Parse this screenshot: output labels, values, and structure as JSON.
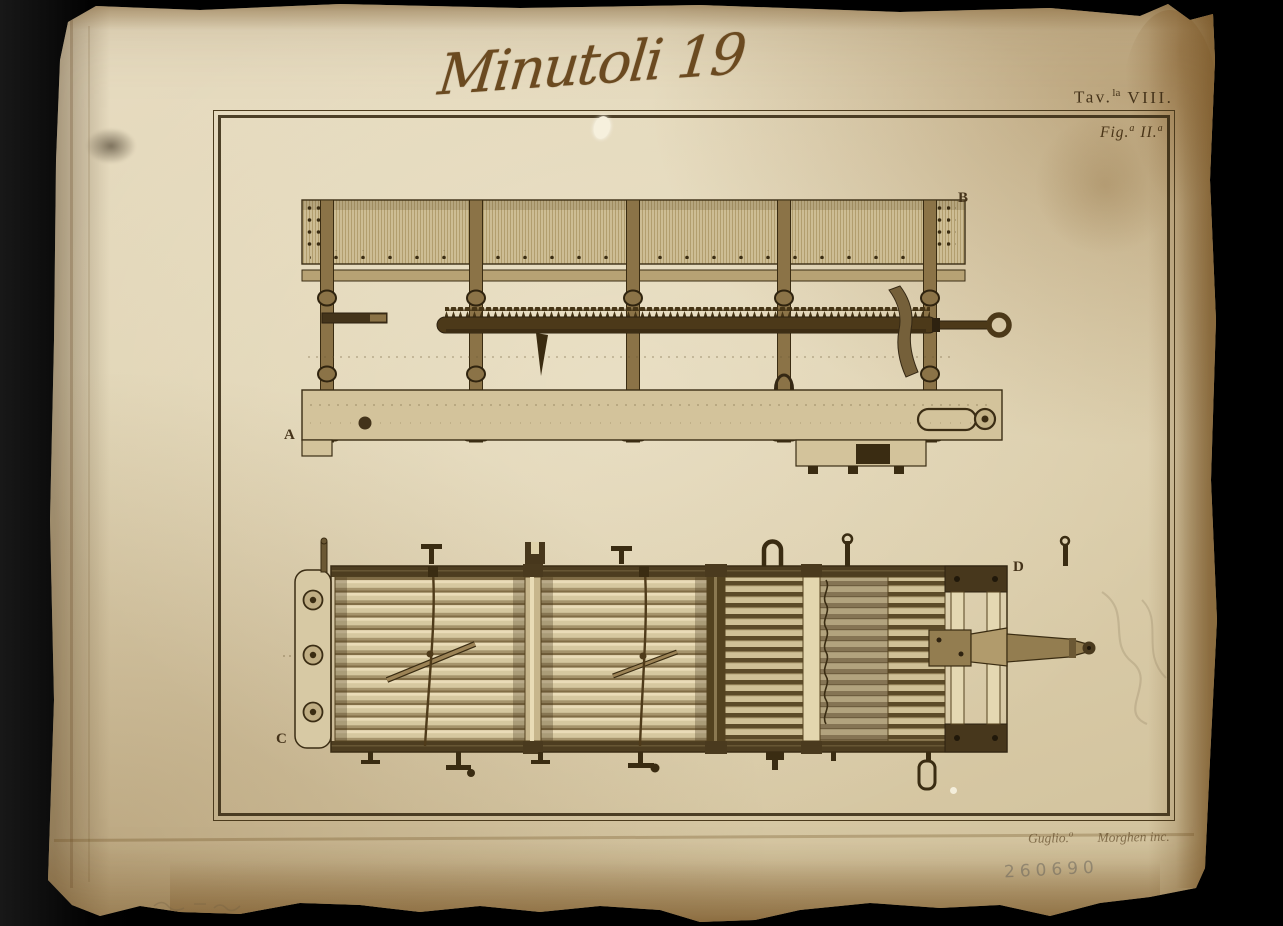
{
  "photo": {
    "backdrop_color": "#050505",
    "paper_color": "#e0d3b2",
    "ink_color": "#45331a",
    "engraving_color": "#4c3919",
    "stamp_color": "#66625a"
  },
  "handwritten_title": "Minutoli 19",
  "plate_labels": {
    "tav": {
      "prefix": "Tav.",
      "sup": "la",
      "numeral": "VIII."
    },
    "fig": {
      "prefix": "Fig.",
      "sup1": "a",
      "numeral": "II.",
      "sup2": "a"
    }
  },
  "part_letters": {
    "a": "A",
    "b": "B",
    "c": "C",
    "d": "D"
  },
  "signature": {
    "name1": "Guglio.",
    "name1_sup": "o",
    "name2": "Morghen inc."
  },
  "stamp_number": "260690"
}
